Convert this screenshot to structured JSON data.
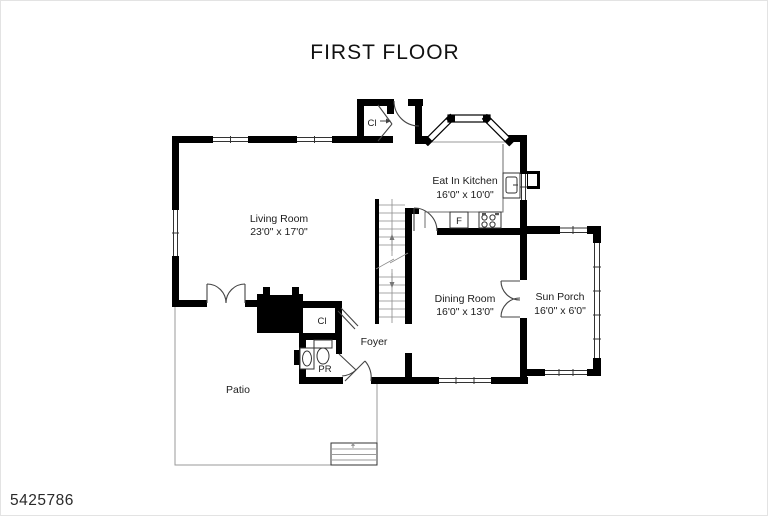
{
  "title": "FIRST FLOOR",
  "image_number": "5425786",
  "rooms": {
    "living_room": {
      "name": "Living Room",
      "dims": "23'0\" x 17'0\""
    },
    "eat_in_kitchen": {
      "name": "Eat In Kitchen",
      "dims": "16'0\" x 10'0\""
    },
    "dining_room": {
      "name": "Dining Room",
      "dims": "16'0\" x 13'0\""
    },
    "sun_porch": {
      "name": "Sun Porch",
      "dims": "16'0\" x 6'0\""
    },
    "foyer": {
      "name": "Foyer"
    },
    "patio": {
      "name": "Patio"
    },
    "powder_room": {
      "label": "PR"
    },
    "closet_hall": {
      "label": "Cl"
    },
    "closet_foyer": {
      "label": "Cl"
    },
    "refrigerator": {
      "label": "F"
    }
  },
  "colors": {
    "walls": "#000000",
    "thin_lines": "#6e6e6e",
    "text": "#1c1c1c",
    "background": "#ffffff"
  }
}
